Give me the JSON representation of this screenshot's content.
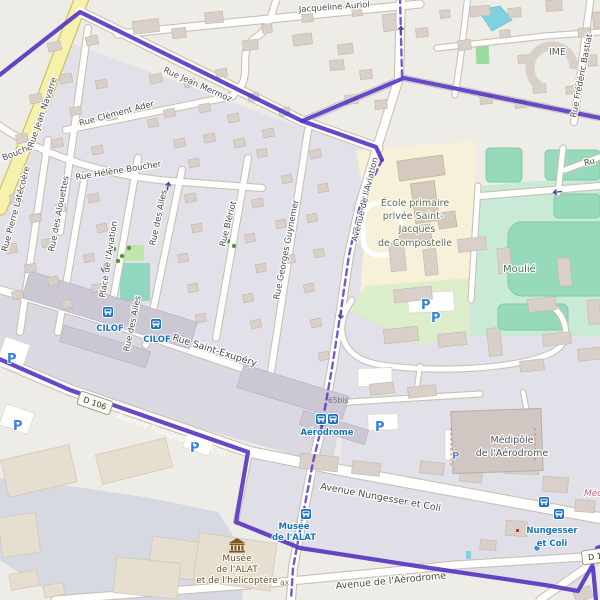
{
  "streets": {
    "jacqueline_auriol": "Jacqueline Auriol",
    "jean_mermoz": "Rue Jean Mermoz",
    "clement_ader": "Rue Clément Ader",
    "helene_boucher": "Rue Hélène Boucher",
    "helene_boucher_2": "Rue Hélène Boucher",
    "jean_navarre": "Rue Jean Navarre",
    "pierre_latecoere": "Rue Pierre Latécoère",
    "des_alouettes": "Rue des Alouettes",
    "place_aviation": "Place de l'Aviation",
    "des_ailes": "Rue des Ailes",
    "des_ailes_2": "Rue des Ailes",
    "bleriot": "Rue Blériot",
    "georges_guynemer": "Rue Georges Guynemer",
    "saint_exupery": "Rue Saint-Exupéry",
    "avenue_aviation": "Avenue de l'Aviation",
    "nungesser_1": "Avenue Nungesser et Coli",
    "nungesser_2": "Avenue Nungesser et Coli",
    "avenue_aerodrome": "Avenue de l'Aérodrome",
    "frederic_bastiat": "Rue Frédéric Bastiat",
    "rue_partial": "Ru"
  },
  "pois": {
    "ecole_l1": "École primaire",
    "ecole_l2": "privée Saint-",
    "ecole_l3": "Jacques",
    "ecole_l4": "de Compostelle",
    "moulie": "Moulié",
    "ime": "IME",
    "medipole_l1": "Médipôle",
    "medipole_l2": "de l'Aérodrome",
    "medipole_partial": "Méd",
    "musee_l1": "Musée",
    "musee_l2": "de l'ALAT",
    "musee_l3": "et de l'hélicoptère",
    "house_65bis": "65bis",
    "partial_ax": "ax"
  },
  "transit": {
    "cilof_1": "CILOF",
    "cilof_2": "CILOF",
    "aerodrome": "Aérodrome",
    "musee_stop_l1": "Musée",
    "musee_stop_l2": "de l'ALAT",
    "nungesser_stop_l1": "Nungesser",
    "nungesser_stop_l2": "et Coli",
    "parking": "P"
  },
  "shields": {
    "d106": "D 106",
    "d_partial": "D 106"
  },
  "colors": {
    "boundary": "#512fc0",
    "road_yellow": "#f6f2ae",
    "residential": "#e2e0e8",
    "industrial": "#dad8e1",
    "building": "#d9d0c9",
    "school": "#f6f1d8",
    "sports": "#c8ead7",
    "pitch": "#97d9bb",
    "park": "#bfe7ab",
    "water": "#7ed2e1",
    "apron": "#d6d9e1",
    "transit_blue": "#1673c1",
    "parking_blue": "#3b82d4",
    "medipole_pink": "#c96080"
  }
}
